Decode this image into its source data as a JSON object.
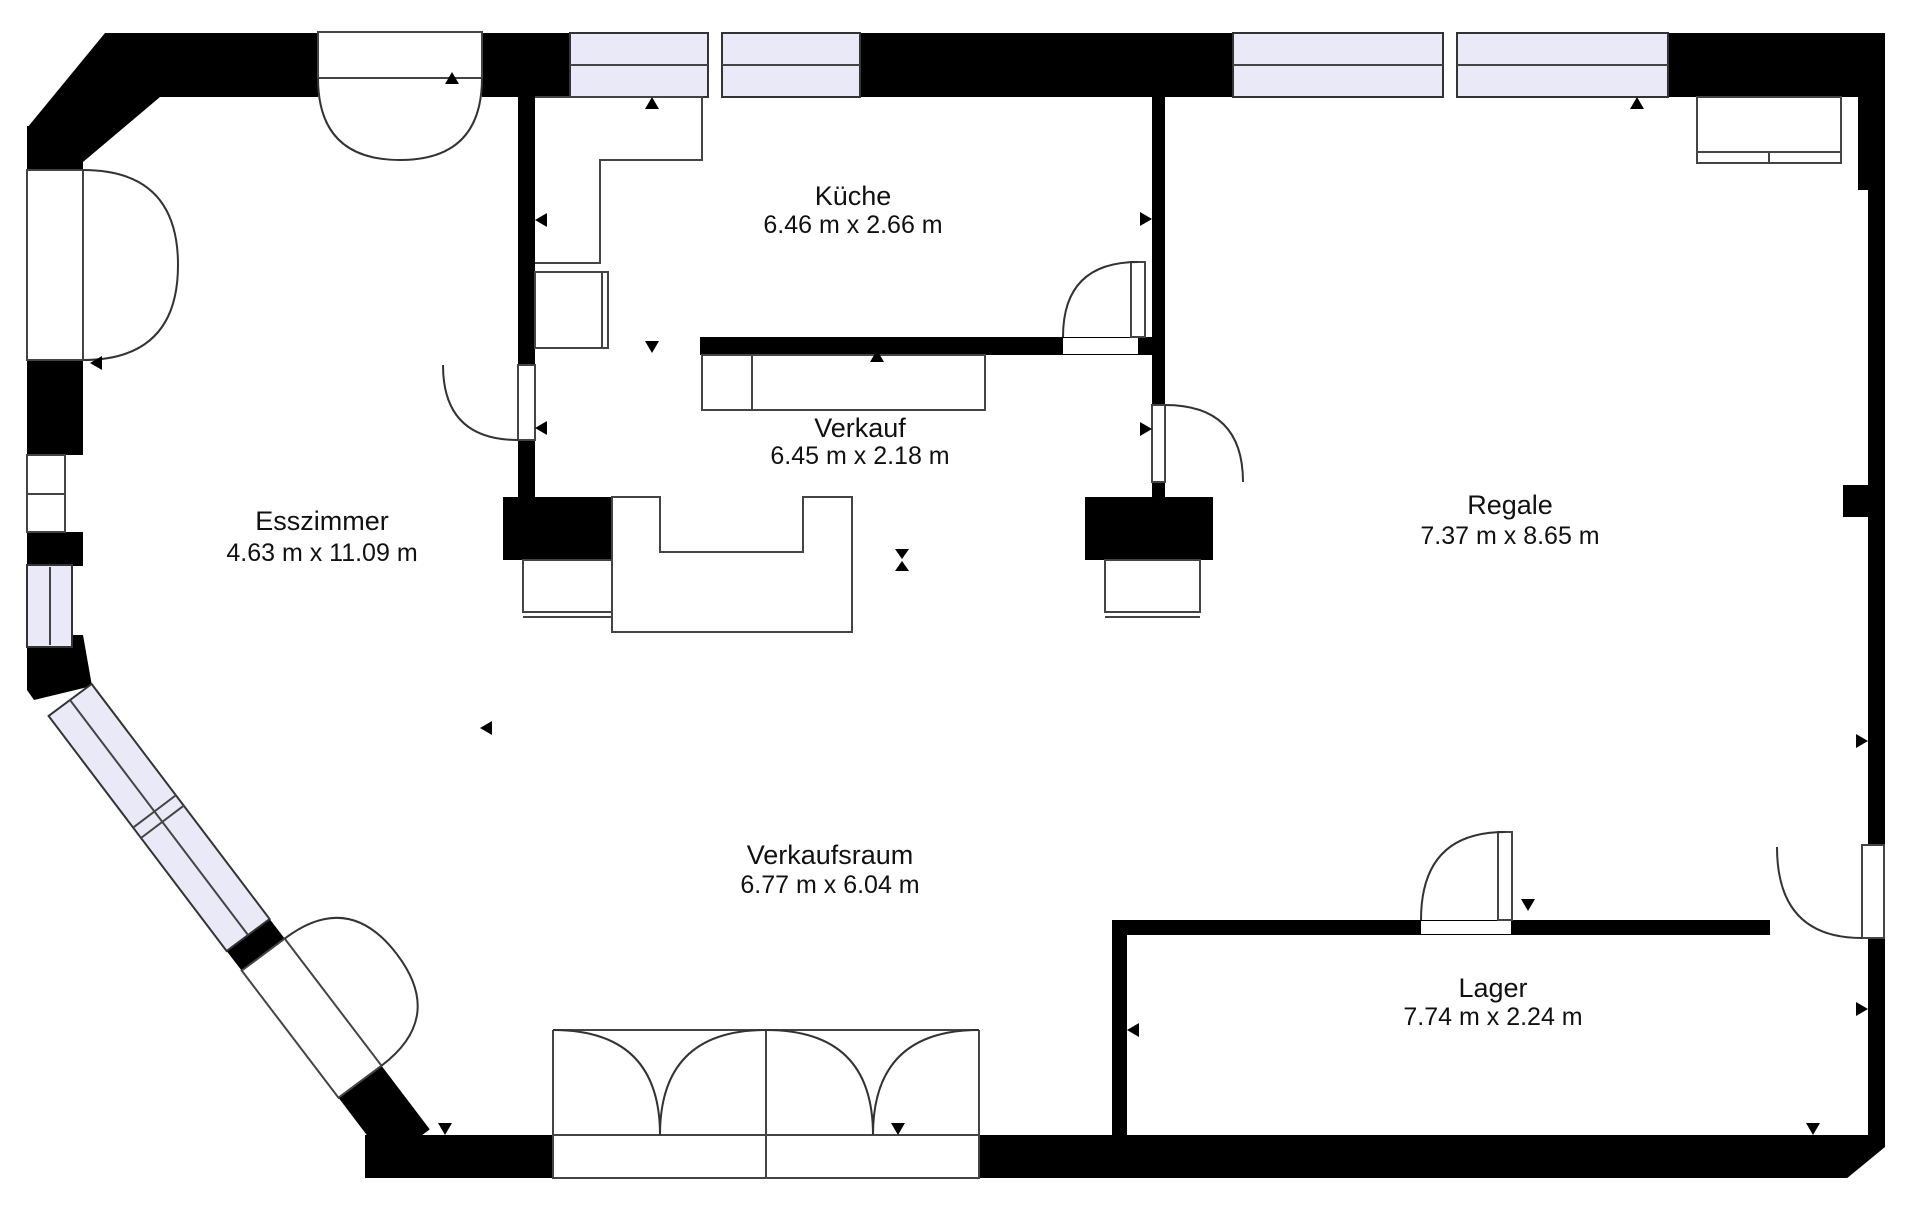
{
  "plan": {
    "type": "floor-plan",
    "rooms": {
      "kueche": {
        "name": "Küche",
        "dims": "6.46 m x 2.66 m"
      },
      "verkauf": {
        "name": "Verkauf",
        "dims": "6.45 m x 2.18 m"
      },
      "esszimmer": {
        "name": "Esszimmer",
        "dims": "4.63 m x 11.09 m"
      },
      "regale": {
        "name": "Regale",
        "dims": "7.37 m x 8.65 m"
      },
      "verkaufsraum": {
        "name": "Verkaufsraum",
        "dims": "6.77 m x 6.04 m"
      },
      "lager": {
        "name": "Lager",
        "dims": "7.74 m x 2.24 m"
      }
    },
    "colors": {
      "wall": "#000000",
      "window_fill": "#e9e9f7",
      "outline": "#333333",
      "text": "#111111",
      "background": "#ffffff"
    }
  }
}
